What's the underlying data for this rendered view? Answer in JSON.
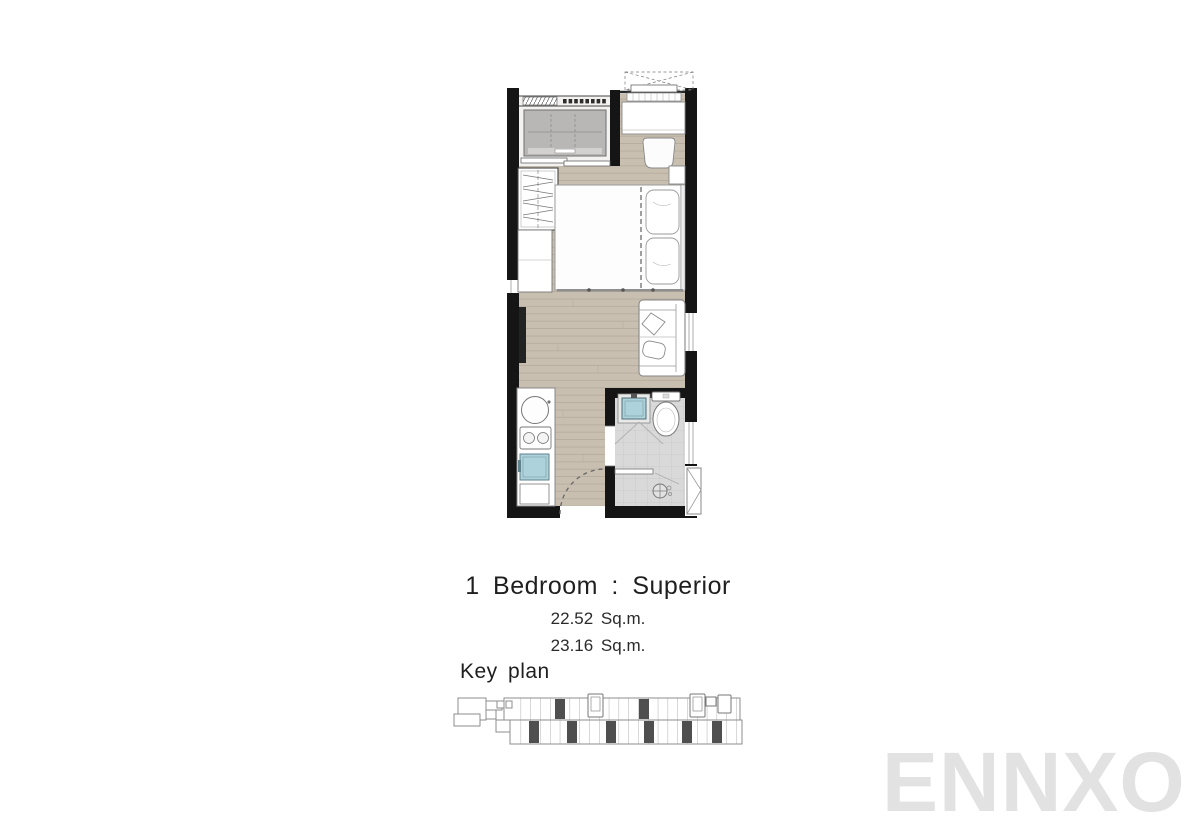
{
  "title_block": {
    "title": "1 Bedroom : Superior",
    "area_line1": "22.52 Sq.m.",
    "area_line2": "23.16 Sq.m."
  },
  "key_plan": {
    "label": "Key plan"
  },
  "watermark": {
    "text": "ENNXO"
  },
  "colors": {
    "background": "#ffffff",
    "wall": "#151515",
    "wood_floor": "#c8bfb1",
    "wood_line": "#b3a99b",
    "tile_floor": "#d9d9d9",
    "tile_line": "#c6c6c6",
    "balcony_floor": "#f3f2f0",
    "appliance": "#b8b7b5",
    "accent_blue": "#aed2db",
    "outline": "#8a8a8a",
    "keyplan_outline": "#8e8e8e",
    "keyplan_highlight": "#4f4f4f",
    "text": "#1f1f1f",
    "watermark": "#e2e2e2"
  }
}
